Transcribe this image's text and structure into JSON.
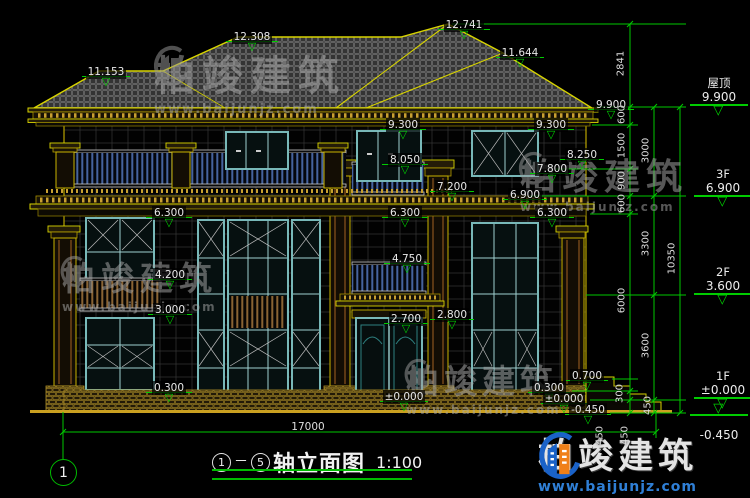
{
  "watermark": {
    "brand": "柏竣建筑",
    "url": "www.baijunjz.com"
  },
  "title": {
    "axis_from": "1",
    "separator": "－",
    "axis_to": "5",
    "name": "轴立面图",
    "scale": "1:100"
  },
  "axis_bubble": "1",
  "floor_levels": {
    "roof": {
      "label": "屋顶",
      "value": "9.900"
    },
    "f3": {
      "label": "3F",
      "value": "6.900"
    },
    "f2": {
      "label": "2F",
      "value": "3.600"
    },
    "f1": {
      "label": "1F",
      "value": "±0.000"
    },
    "base": {
      "label": "",
      "value": "-0.450"
    }
  },
  "elev": {
    "e11153": "11.153",
    "e12308": "12.308",
    "e12741": "12.741",
    "e11644": "11.644",
    "e9900": "9.900",
    "e9300a": "9.300",
    "e9300b": "9.300",
    "e8250": "8.250",
    "e8050": "8.050",
    "e7800": "7.800",
    "e7200": "7.200",
    "e6900": "6.900",
    "e6300a": "6.300",
    "e6300b": "6.300",
    "e6300c": "6.300",
    "e4750": "4.750",
    "e4200": "4.200",
    "e3000": "3.000",
    "e2700": "2.700",
    "e2800": "2.800",
    "e0000door": "±0.000",
    "e0300l": "0.300",
    "e0700": "0.700",
    "e0300r": "0.300",
    "e0000r": "±0.000",
    "en450": "-0.450"
  },
  "dims": {
    "roof_height": "2841",
    "inner": {
      "d600a": "600",
      "d1500": "1500",
      "d900": "900",
      "d600b": "600",
      "d6000": "6000",
      "d300": "300",
      "d450a": "450"
    },
    "mid": {
      "d3000": "3000",
      "d3300": "3300",
      "d3600": "3600",
      "d450b": "450"
    },
    "steps_450": "450",
    "total": "10350",
    "width": "17000"
  },
  "colors": {
    "dim_green": "#00cc00",
    "line_yellow": "#d8d400",
    "text_white": "#e8e8e8"
  }
}
